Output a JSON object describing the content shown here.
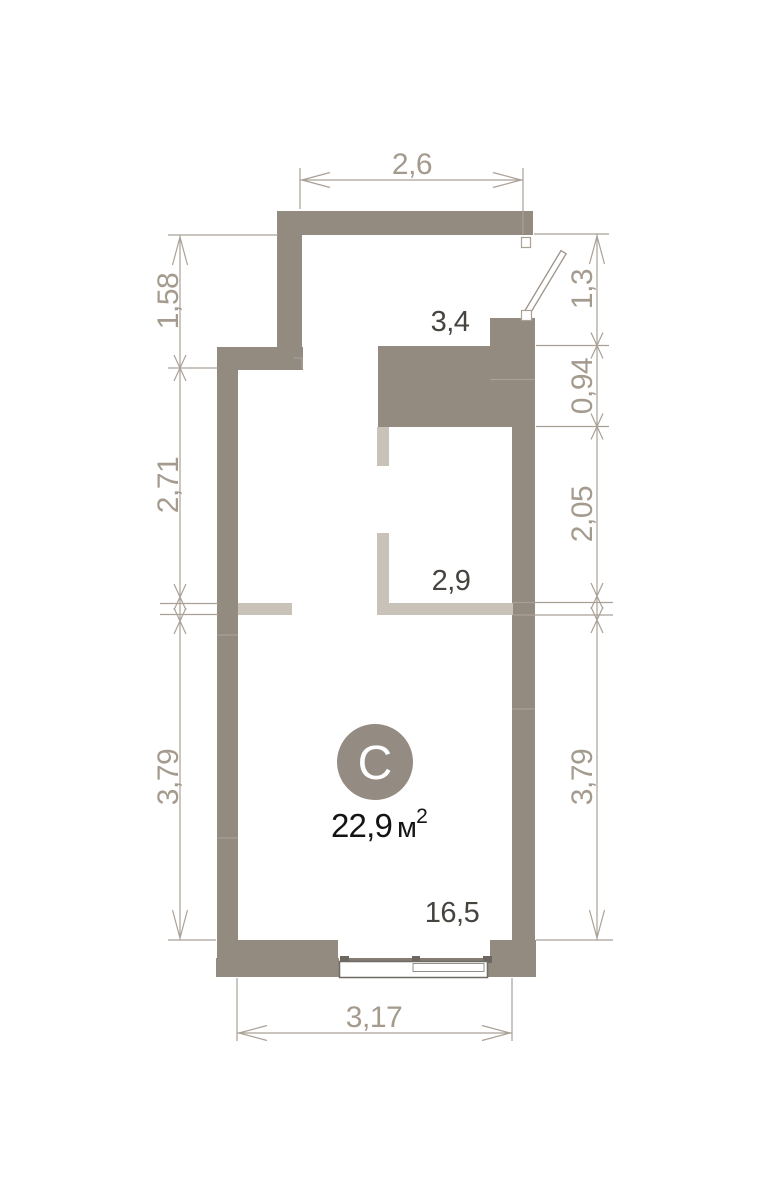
{
  "floorplan": {
    "room_badge_letter": "C",
    "area": {
      "value": "22,9",
      "unit": "м",
      "superscript": "2"
    },
    "interior_labels": {
      "kitchen_zone_width": "3,4",
      "alcove_width": "2,9",
      "main_room_area": "16,5"
    },
    "dimensions": {
      "top": "2,6",
      "bottom": "3,17",
      "left": [
        "1,58",
        "2,71",
        "3,79"
      ],
      "right": [
        "1,3",
        "0,94",
        "2,05",
        "3,79"
      ]
    },
    "colors": {
      "background": "#ffffff",
      "wall": "#938a80",
      "partition": "#c8c2b9",
      "wall_seam": "#a9a096",
      "dim_line": "#aaa196",
      "dim_text": "#a49b8e",
      "interior_label": "#474440",
      "area_text": "#141414",
      "room_badge": "#948b82",
      "badge_letter": "#ffffff",
      "window_frame": "#6e6a65",
      "window_pane": "#94908a",
      "window_sill": "#857d74",
      "window_post": "#6e6761",
      "door_leaf_stroke": "#9b9289"
    }
  }
}
